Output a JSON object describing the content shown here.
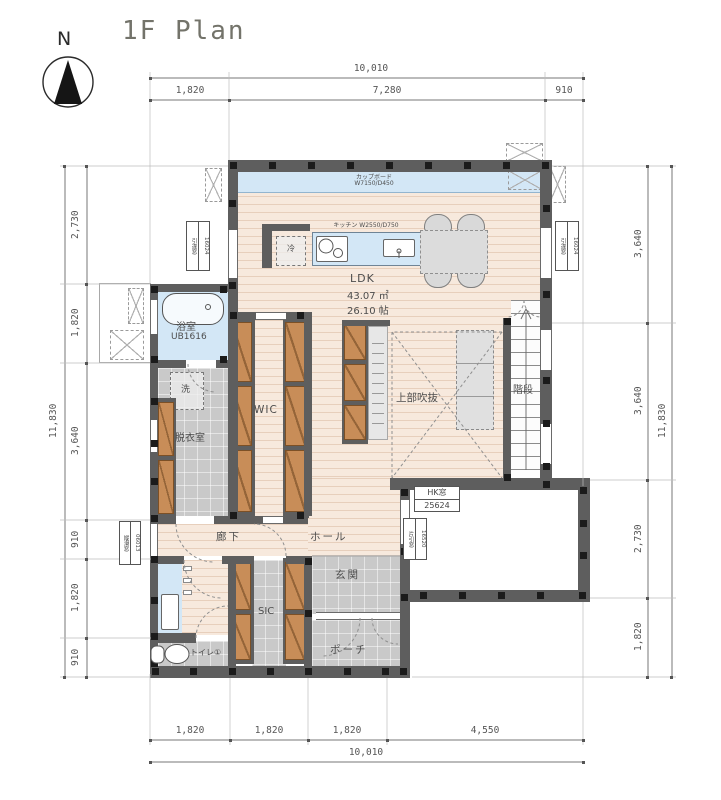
{
  "title": "1F Plan",
  "compass": {
    "north": "N"
  },
  "dims": {
    "top": {
      "total": "10,010",
      "segments": [
        "1,820",
        "7,280",
        "910"
      ]
    },
    "bottom": {
      "total": "10,010",
      "segments": [
        "1,820",
        "1,820",
        "1,820",
        "4,550"
      ]
    },
    "left": {
      "total": "11,830",
      "segments": [
        "2,730",
        "1,820",
        "3,640",
        "910",
        "1,820",
        "910"
      ]
    },
    "right": {
      "total": "11,830",
      "segments": [
        "3,640",
        "3,640",
        "2,730",
        "1,820"
      ]
    }
  },
  "rooms": {
    "ldk": {
      "name": "LDK",
      "area_m2": "43.07 ㎡",
      "area_jo": "26.10 帖"
    },
    "void": "上部吹抜",
    "stairs": "階段",
    "wic": "WIC",
    "bath": {
      "name": "浴室",
      "unit": "UB1616"
    },
    "dressing": "脱衣室",
    "washer": "洗",
    "corridor": "廊下",
    "hall": "ホール",
    "entrance": "玄関",
    "sic": "SIC",
    "porch": "ポーチ",
    "toilet": "トイレ①",
    "fridge": "冷"
  },
  "fixtures": {
    "cupboard": {
      "name": "カップボード",
      "size": "W7150/D450"
    },
    "kitchen": {
      "label": "キッチン W2550/D750"
    }
  },
  "tags": {
    "window_nw": {
      "name": "引違窓",
      "code": "16024"
    },
    "window_ne": {
      "name": "引違窓",
      "code": "16024"
    },
    "entry_window": {
      "name": "HK窓",
      "code": "25624"
    },
    "hall_window": {
      "name": "片引窓",
      "code": "16520"
    },
    "wash_window": {
      "name": "縦滑窓",
      "code": "06013"
    }
  },
  "colors": {
    "wall": "#5e5e5e",
    "wood": "#f7e9dd",
    "tile": "#c9c9c9",
    "water": "#d3e7f6",
    "cabinet": "#c88d58"
  }
}
